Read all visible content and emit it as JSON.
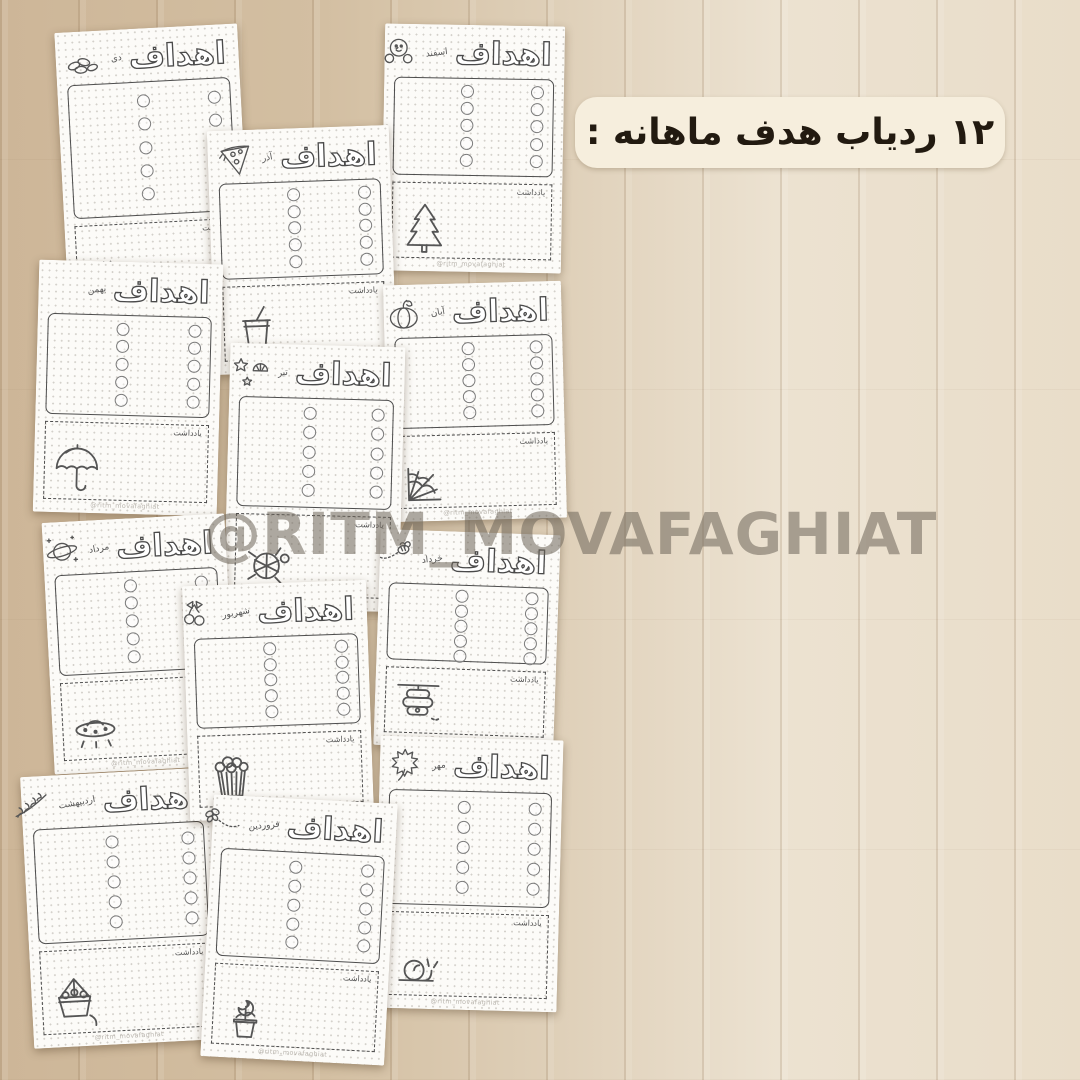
{
  "title_badge": {
    "text": "۱۲ ردیاب هدف ماهانه :"
  },
  "watermark": {
    "text": "@RITM_MOVAFAGHIAT"
  },
  "labels": {
    "goals_title": "اهداف",
    "notes_label": "یادداشت",
    "page_footer": "@ritm_movafaghiat"
  },
  "doodle_texts": {
    "coffee_cup": "Coffee"
  },
  "colors": {
    "badge_bg": "#f6eedd",
    "badge_text": "#221a10",
    "watermark": "#6e665a",
    "wood_dark": "#cdb698",
    "wood_light": "#ece2d1",
    "page_bg": "#fcfbf8",
    "ink": "#4d4d4d"
  },
  "pages": [
    {
      "month": "دی",
      "header_doodle": "seeds-icon",
      "notes_doodle": "coffee-cup-icon"
    },
    {
      "month": "اسفند",
      "header_doodle": "snowman-icon",
      "notes_doodle": "pine-tree-icon"
    },
    {
      "month": "آذر",
      "header_doodle": "pizza-icon",
      "notes_doodle": "soda-cup-icon"
    },
    {
      "month": "بهمن",
      "header_doodle": "",
      "notes_doodle": "umbrella-icon"
    },
    {
      "month": "آبان",
      "header_doodle": "pumpkin-icon",
      "notes_doodle": "spiderweb-icon"
    },
    {
      "month": "تیر",
      "header_doodle": "seashells-icon",
      "notes_doodle": "turtle-icon"
    },
    {
      "month": "مرداد",
      "header_doodle": "planet-icon",
      "notes_doodle": "ufo-icon"
    },
    {
      "month": "خرداد",
      "header_doodle": "bee-icon",
      "notes_doodle": "beehive-icon"
    },
    {
      "month": "شهریور",
      "header_doodle": "cherries-icon",
      "notes_doodle": "popcorn-icon"
    },
    {
      "month": "مهر",
      "header_doodle": "maple-leaf-icon",
      "notes_doodle": "snail-icon"
    },
    {
      "month": "اردیبهشت",
      "header_doodle": "lavender-icon",
      "notes_doodle": "flower-basket-icon"
    },
    {
      "month": "فروردین",
      "header_doodle": "butterfly-icon",
      "notes_doodle": "rose-pot-icon"
    }
  ]
}
